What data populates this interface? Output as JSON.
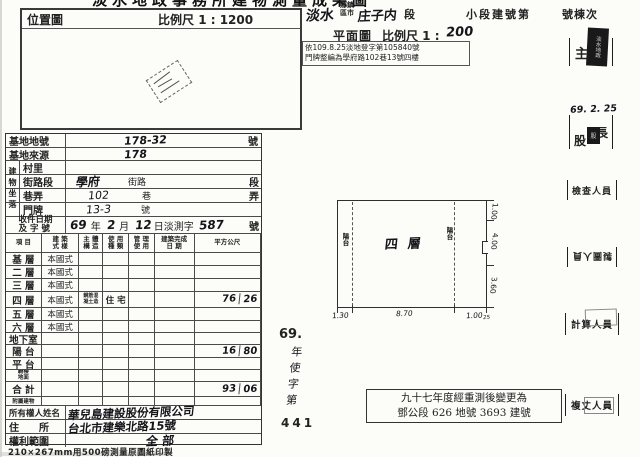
{
  "page": {
    "title_partial": "淡水地政事務所建物測量成果圖",
    "paper_note": "210×267mm用500磅測量原圖紙印製"
  },
  "location_map": {
    "label": "位置圖",
    "scale": "比例尺 1 : 1200"
  },
  "header": {
    "township_value": "淡水",
    "township_label": "鄉鎮\n區市",
    "section_value": "庄子内",
    "section_label": "段",
    "subsection_label": "小段建號第",
    "unit_label": "號棟次",
    "plan_label": "平面圖",
    "plan_scale_label": "比例尺 1 :",
    "plan_scale_value": "200",
    "note_line1": "依109.8.25淡地登字第105840號",
    "note_line2": "門牌整編為學府路102巷13號四樓"
  },
  "site": {
    "lot_label": "基地地號",
    "lot_value": "178-32",
    "lot_suffix": "號",
    "source_label": "基地來源",
    "source_value": "178",
    "location_group": "建物坐落",
    "village_label": "村里",
    "street_label": "街路段",
    "street_value": "學府",
    "street_mid": "街路",
    "street_suffix": "段",
    "lane_label": "巷弄",
    "lane_value": "102",
    "lane_mid": "巷",
    "lane_suffix": "弄",
    "door_label": "門牌",
    "door_value": "13-3",
    "door_mid": "號",
    "receipt_label": "收件日期\n及 字 號",
    "receipt_year_v": "69",
    "receipt_year": "年",
    "receipt_month_v": "2",
    "receipt_month": "月",
    "receipt_day_v": "12",
    "receipt_day": "日淡測字",
    "receipt_no_v": "587",
    "receipt_no": "號"
  },
  "floor_table": {
    "headers": [
      "項 目",
      "建 築\n式 樣",
      "主 體\n構 造",
      "使 用\n種 類",
      "管 理\n使 用",
      "建築完成\n日 期",
      "平方公尺"
    ],
    "rows": [
      {
        "floor": "基 層",
        "style": "本國式"
      },
      {
        "floor": "二 層",
        "style": "本國式"
      },
      {
        "floor": "三 層",
        "style": "本國式"
      },
      {
        "floor": "四 層",
        "style": "本國式",
        "struct": "鋼筋混\n凝土造",
        "use": "住 宅",
        "area": "76",
        "dec": "26"
      },
      {
        "floor": "五 層",
        "style": "本國式"
      },
      {
        "floor": "六 層",
        "style": "本國式"
      },
      {
        "floor": "地下室"
      },
      {
        "floor": "陽 台",
        "area": "16",
        "dec": "80"
      },
      {
        "floor": "平 台"
      },
      {
        "floor": "騎樓\n地面"
      },
      {
        "floor": "合 計",
        "area": "93",
        "dec": "06"
      },
      {
        "floor": "附屬建物"
      }
    ]
  },
  "owner": {
    "name_label": "所有權人姓名",
    "name_value": "華兒島建設股份有限公司",
    "addr_label": "住　　所",
    "addr_value": "台北市建樂北路15號",
    "scope_label": "權利範圍",
    "scope_value": "全 部"
  },
  "plan": {
    "floor_label": "四層",
    "balcony_left": "陽台",
    "balcony_right": "陽台",
    "dim_bottom_left": "1.30",
    "dim_bottom_center": "8.70",
    "dim_bottom_right": "1.00",
    "dim_bottom_small": "25",
    "dim_right_top": "1.00",
    "dim_right_mid": "4.00",
    "dim_right_bottom": "3.60"
  },
  "license": {
    "year": "69.",
    "chars": "年使字第",
    "number": "441"
  },
  "remark": {
    "line1": "九十七年度經重測後變更為",
    "line2": "鄧公段 626 地號 3693 建號"
  },
  "officials": [
    {
      "label": "主",
      "stamp_text": "淡水地政"
    },
    {
      "label_a": "股",
      "label_b": "長",
      "stamp_text": "股",
      "date": "69. 2. 25"
    },
    {
      "label": "檢查人員"
    },
    {
      "label": "製圖人員"
    },
    {
      "label": "計算人員"
    },
    {
      "label": "複丈人員"
    }
  ]
}
